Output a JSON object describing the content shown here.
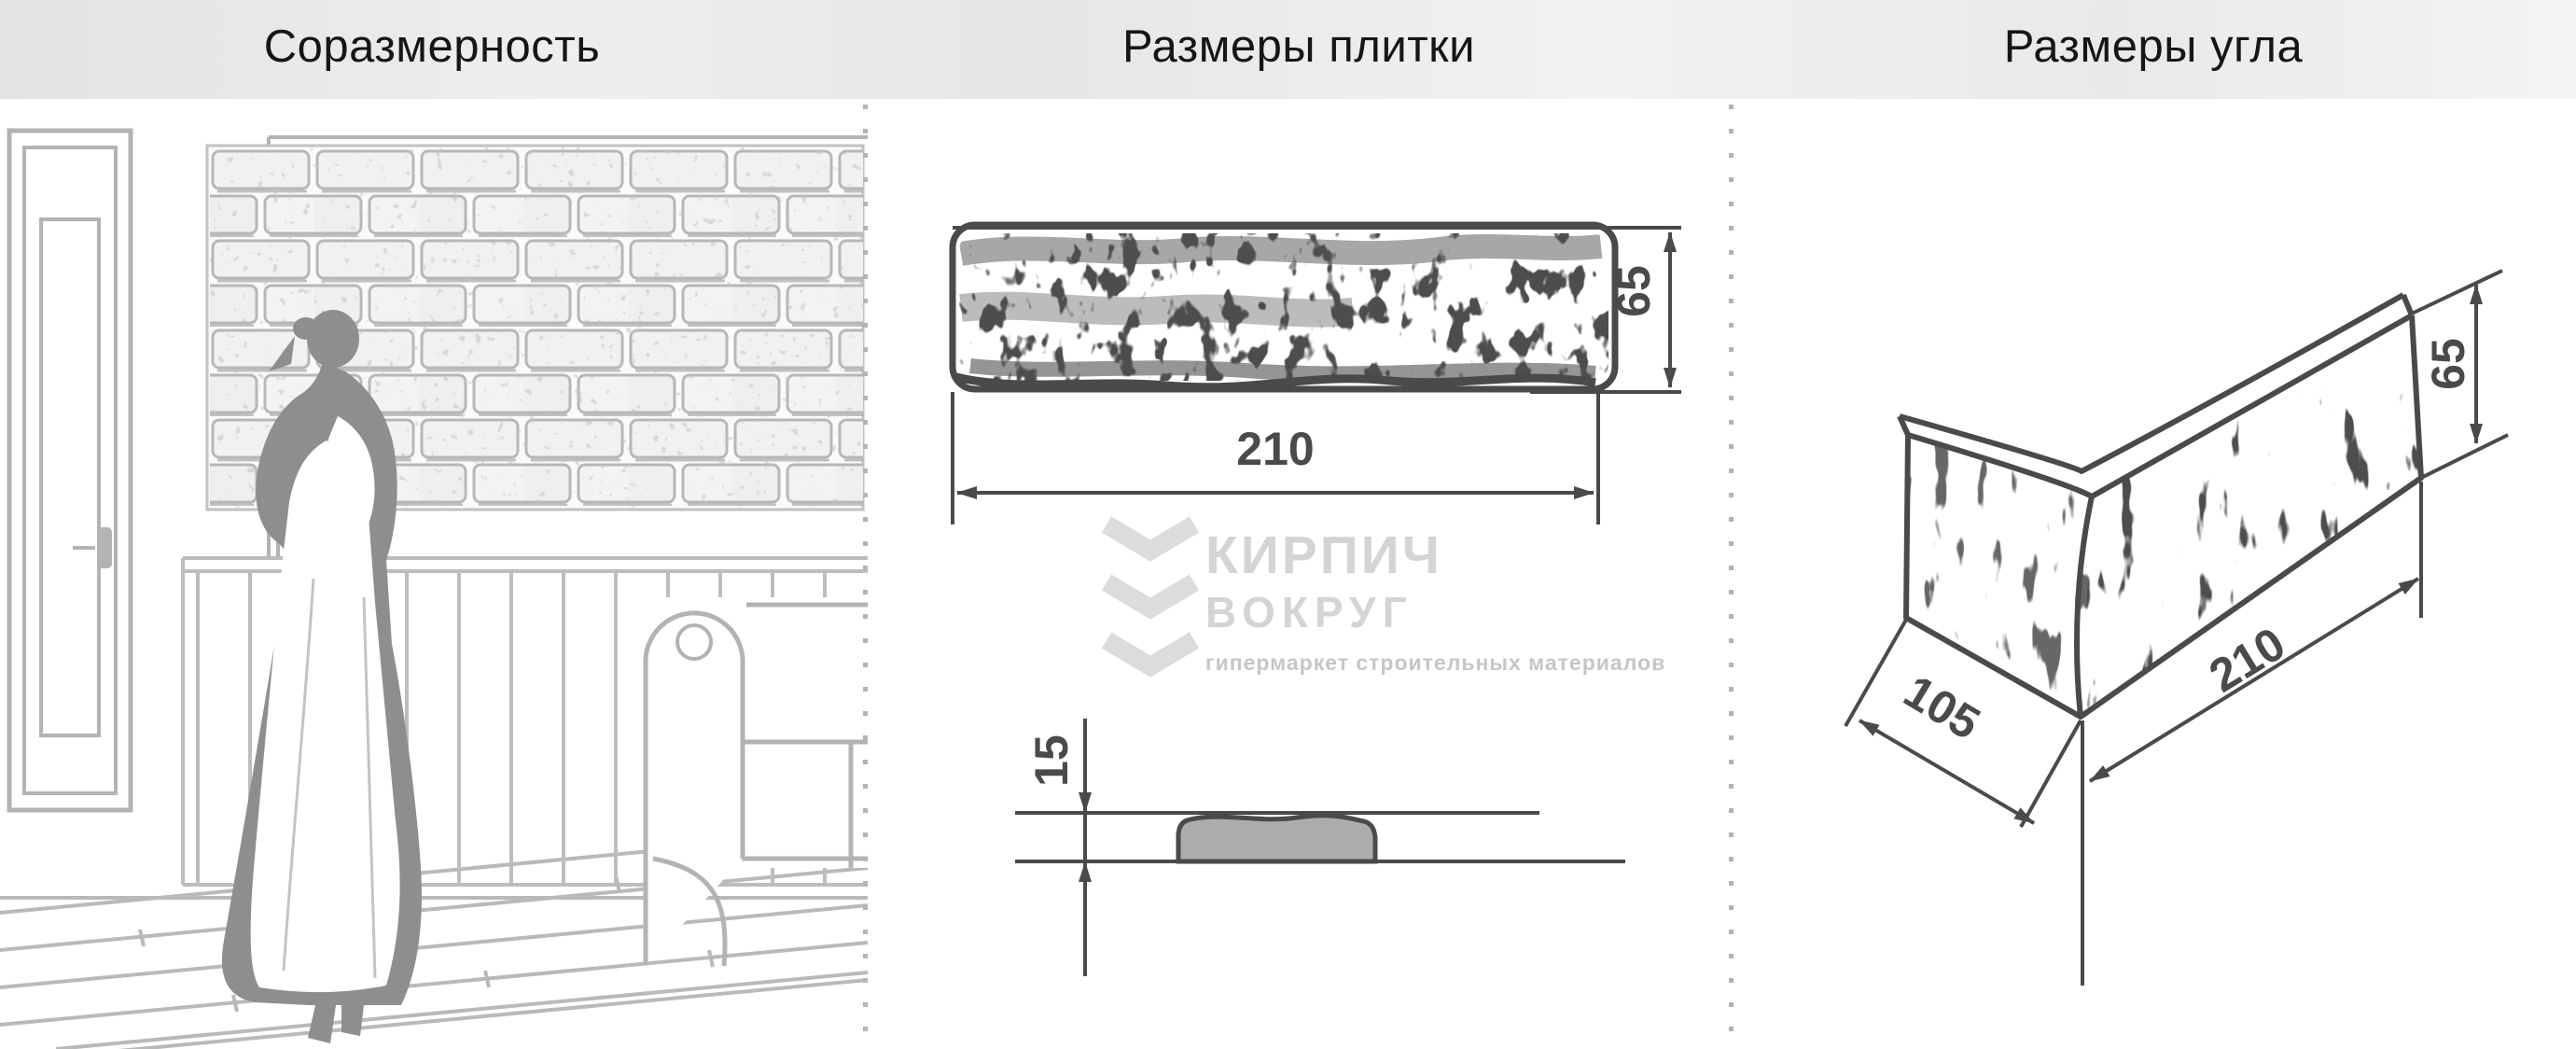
{
  "header": {
    "left_title": "Соразмерность",
    "middle_title": "Размеры плитки",
    "right_title": "Размеры угла"
  },
  "tile": {
    "width_label": "210",
    "height_label": "65",
    "thickness_label": "15"
  },
  "corner": {
    "depth_label": "105",
    "length_label": "210",
    "height_label": "65"
  },
  "watermark": {
    "brand_line1": "КИРПИЧ",
    "brand_line2": "ВОКРУГ",
    "tagline": "гипермаркет строительных материалов"
  },
  "colors": {
    "dimension": "#4a4a4a",
    "scene_outline": "#b3b3b3",
    "silhouette": "#8e8e8e",
    "watermark": "#d4d4d4",
    "header_text": "#161616",
    "divider_dots": "#b3b3b3",
    "profile_fill": "#acacac"
  }
}
